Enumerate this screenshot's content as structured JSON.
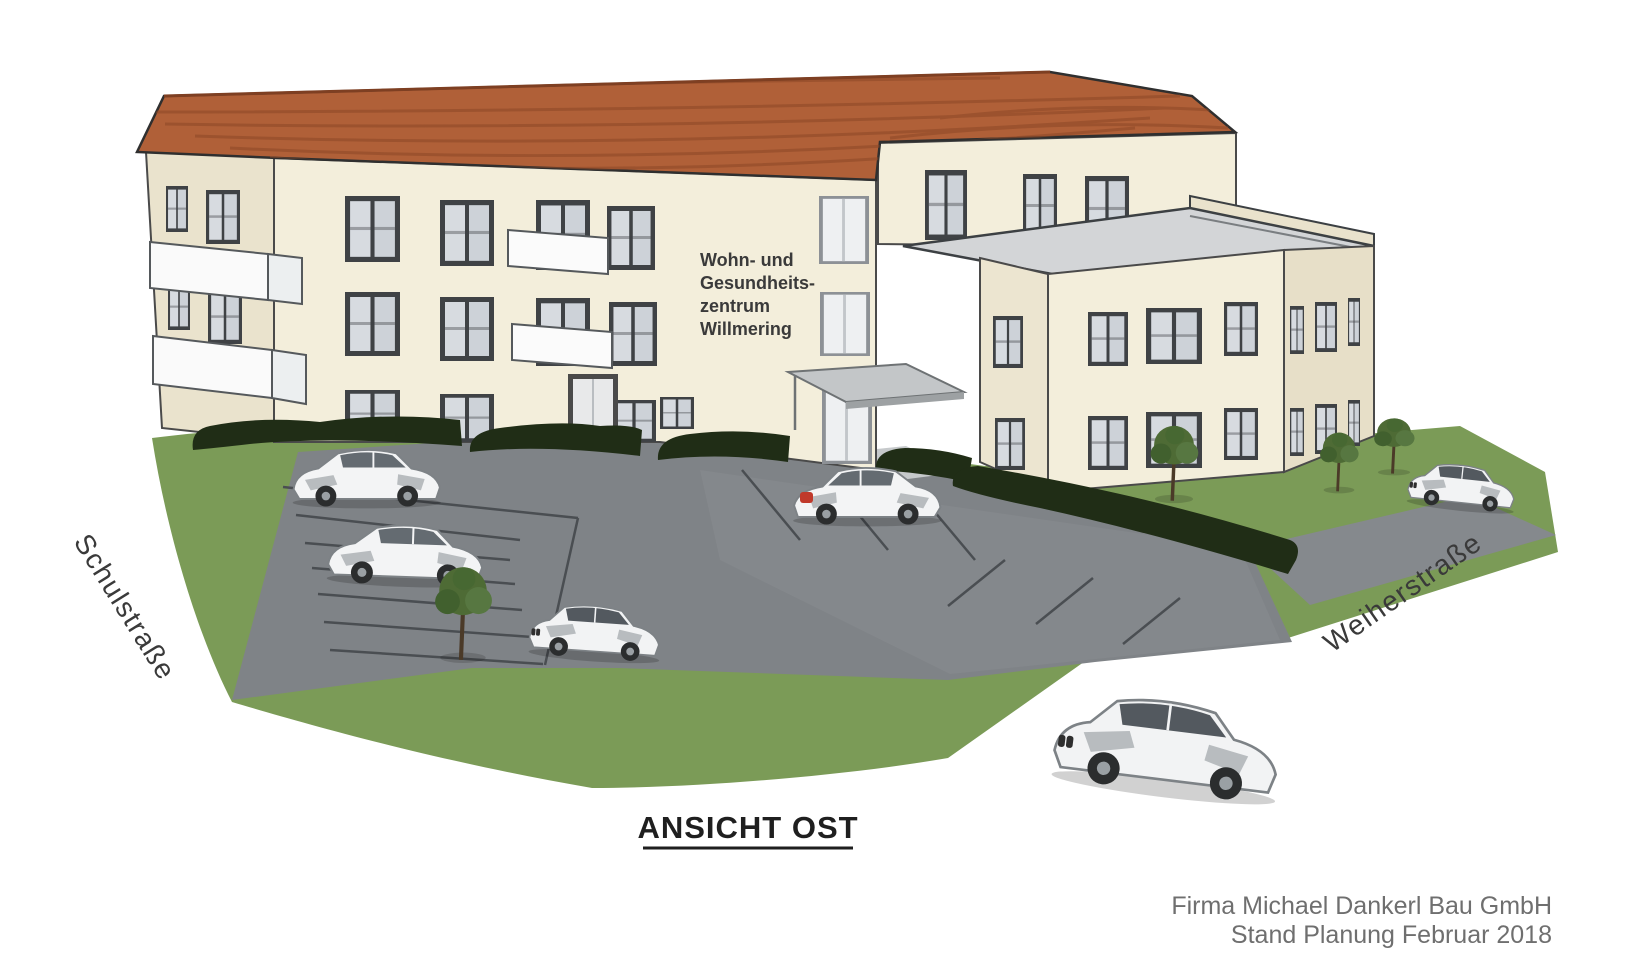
{
  "building": {
    "label_lines": [
      "Wohn- und",
      "Gesundheits-",
      "zentrum",
      "Willmering"
    ]
  },
  "streets": {
    "left_label": "Schulstraße",
    "right_label": "Weiherstraße"
  },
  "caption": {
    "text": "ANSICHT OST"
  },
  "credits": {
    "line1": "Firma Michael Dankerl Bau GmbH",
    "line2": "Stand Planung Februar 2018"
  },
  "colors": {
    "roof": "#b06038",
    "roof_line": "#8f4a28",
    "wall": "#f3eedb",
    "wall_shade": "#eae3cd",
    "flat_roof": "#d3d5d7",
    "grass": "#7b9b57",
    "asphalt": "#7f8387",
    "hedge": "#202d16",
    "window_frame": "#3f4245",
    "text_dark": "#3a3a3a",
    "credit_gray": "#6f6f6f"
  }
}
